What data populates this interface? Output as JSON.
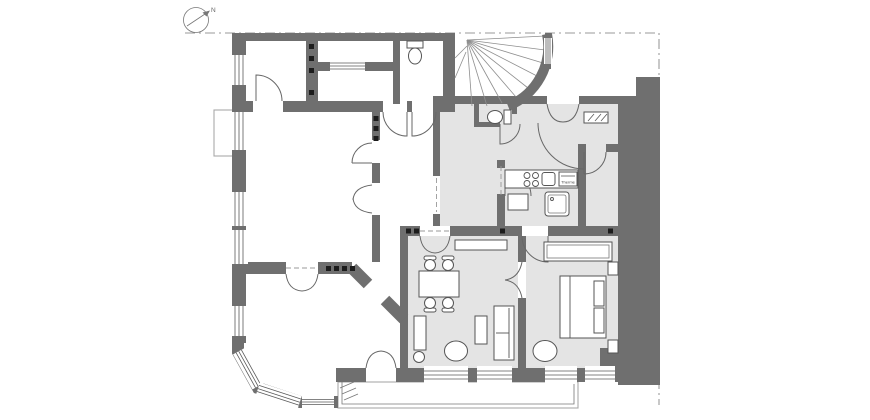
{
  "title": "apartment-floor-plan",
  "compass": {
    "label": "N"
  },
  "kitchen": {
    "water_heater_label": "Therme"
  },
  "colors": {
    "wall": "#6f6f6f",
    "room_shade": "#e4e4e4",
    "line": "#555555",
    "boundary": "#9a9a9a",
    "background": "#ffffff"
  }
}
